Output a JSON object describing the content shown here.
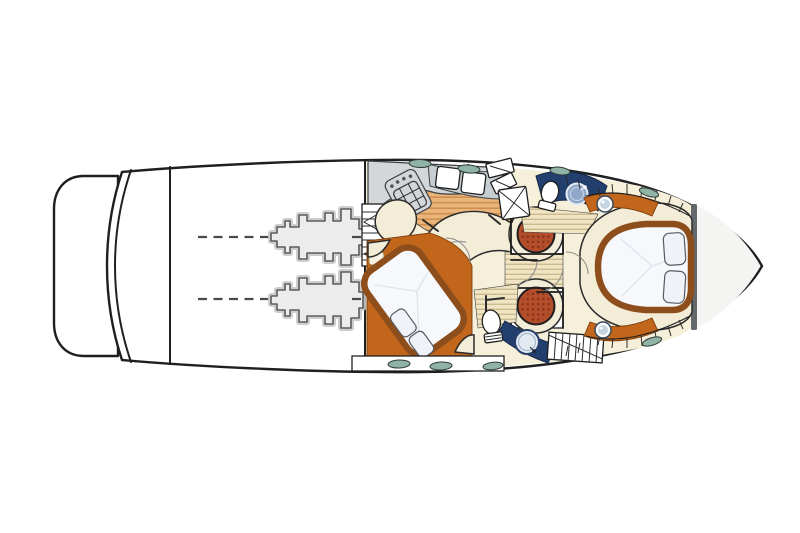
{
  "diagram": {
    "subject": "motor-yacht-lower-deck-floor-plan",
    "orientation": {
      "bow": "right",
      "stern": "left"
    },
    "background": "#ffffff"
  },
  "colors": {
    "outline": "#1f1f1f",
    "hull_fill": "#ffffff",
    "interior_cream": "#f6efd9",
    "seat_cream": "#f3edd8",
    "accent_orange": "#c2661c",
    "bed_frame_brown": "#8e4e1c",
    "bed_white": "#f7f8fb",
    "navy": "#223f6e",
    "sink_blue": "#8fa7c9",
    "table_red": "#b34d2b",
    "table_dot": "#7c2f14",
    "fixture_gray": "#d3d7da",
    "steel_gray": "#c7ced2",
    "hatch_teal": "#8fb3a4",
    "engine_fill": "#ececec",
    "engine_stroke": "#5c5c5c",
    "shaft_dash": "#4a4a4a",
    "bulkhead_gray": "#63686c",
    "porthole_blue": "#c4d4e0",
    "teak_base": "#eab579",
    "teak_stripe": "#cf8f52",
    "teak_light_base": "#efe4c4",
    "teak_light_stripe": "#ccba8e"
  },
  "semantics": {
    "swim_platform": "Swim platform",
    "engine_room": "Engine room with twin engines and propeller shafts",
    "galley": "Galley with stove and double sink",
    "salon": "Salon seating",
    "aft_cabin": "Mid cabin with double berth",
    "head_port": "Port head with sink, toilet and shower",
    "head_starboard": "Starboard head with sink and toilet",
    "corridor": "Companionway corridor with dinette tables",
    "forward_cabin": "Forward cabin with island berth",
    "bow_locker": "Anchor locker"
  },
  "inventory": {
    "engines": 2,
    "dinette_tables": 2,
    "heads": 2,
    "berths": 2,
    "stairways": 3,
    "deck_hatches": 8,
    "portholes": 2,
    "sinks": 3,
    "toilets": 2,
    "stoves": 1
  }
}
